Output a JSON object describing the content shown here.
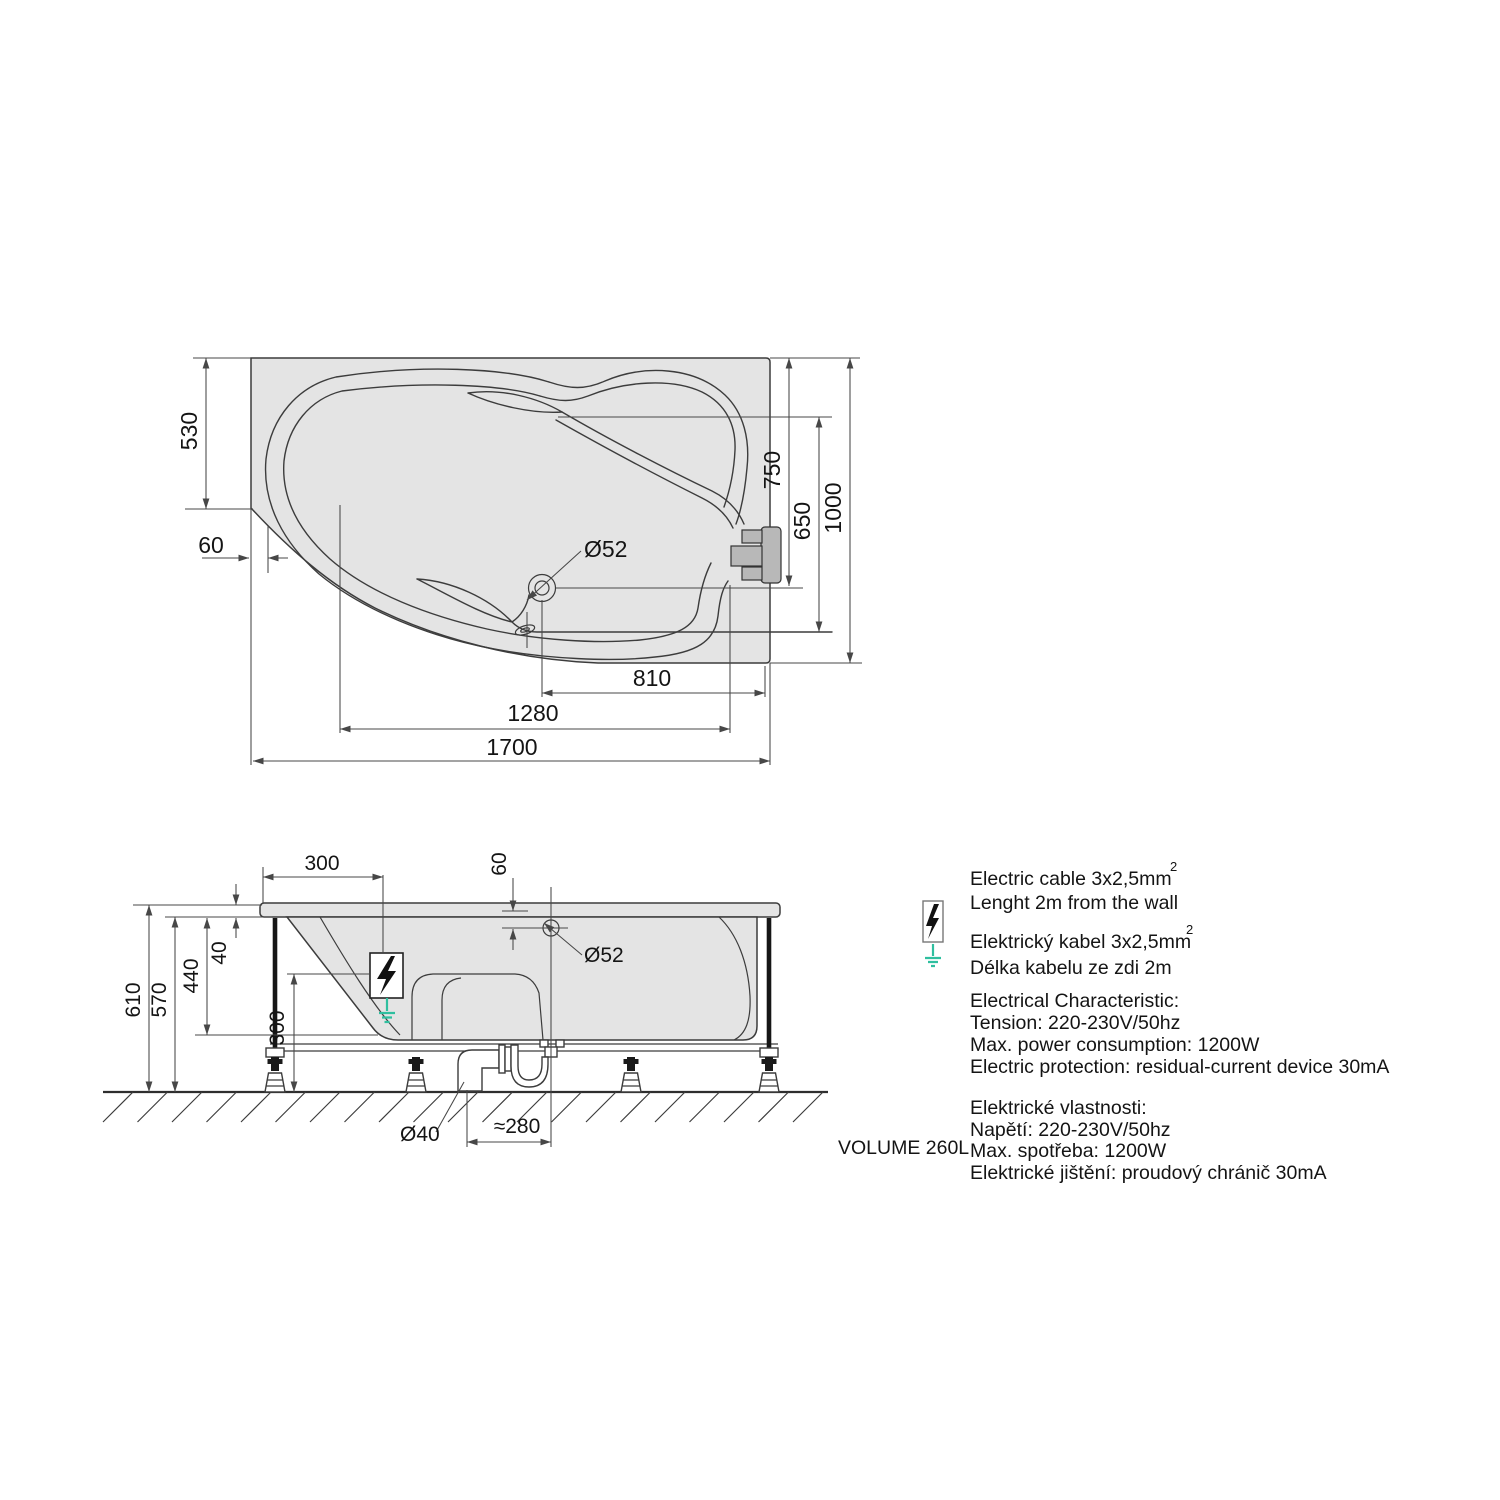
{
  "top_view": {
    "dims": {
      "corner_depth": "530",
      "rim_offset": "60",
      "drain_axis_from_top": "750",
      "jet_axis_from_top": "650",
      "width": "1000",
      "drain_to_right_edge": "810",
      "faucet_span": "1280",
      "length": "1700",
      "drain_diameter": "Ø52"
    }
  },
  "side_view": {
    "dims": {
      "cable_position": "300",
      "drain_offset": "60",
      "rim_thickness": "40",
      "inner_depth": "440",
      "frame_clearance": "300",
      "total_height": "610",
      "shell_height": "570",
      "drain_diameter": "Ø52",
      "waste_diameter": "Ø40",
      "trap_offset": "≈280"
    },
    "volume_label": "VOLUME 260L"
  },
  "notes": {
    "superscript": "2",
    "cable_en_1": "Electric cable 3x2,5mm",
    "cable_en_2": "Lenght 2m from the wall",
    "cable_cz_1": "Elektrický kabel 3x2,5mm",
    "cable_cz_2": "Délka kabelu ze zdi 2m",
    "elec_en_title": "Electrical Characteristic:",
    "elec_en_1": "Tension: 220-230V/50hz",
    "elec_en_2": "Max. power consumption: 1200W",
    "elec_en_3": "Electric protection: residual-current device 30mA",
    "elec_cz_title": "Elektrické vlastnosti:",
    "elec_cz_1": "Napětí: 220-230V/50hz",
    "elec_cz_2": "Max. spotřeba: 1200W",
    "elec_cz_3": "Elektrické jištění: proudový chránič 30mA"
  },
  "colors": {
    "fill_gray": "#e4e4e4",
    "line": "#3c3c3c",
    "dim_line": "#474747",
    "ground_green": "#2fbf9f",
    "faucet_gray": "#b8b8b8"
  }
}
